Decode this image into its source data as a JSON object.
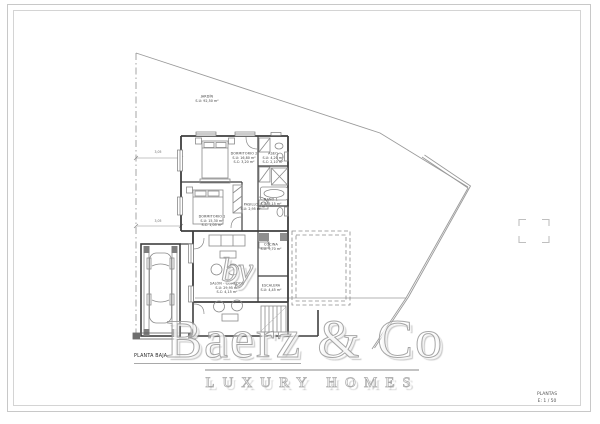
{
  "title_block": {
    "floor_label": "PLANTA BAJA",
    "sheet_name": "PLANTAS",
    "scale": "E: 1 / 50"
  },
  "watermark": {
    "prefix": "by",
    "brand": "Baerz & Co",
    "tagline": "LUXURY HOMES"
  },
  "rooms": {
    "jardin": {
      "name": "JARDÍN",
      "area": "S.U: 92,50 m²"
    },
    "dormitorio2": {
      "name": "DORMITORIO 2",
      "area": "S.U: 16,80 m²",
      "area2": "S.C: 3,20 m²"
    },
    "aseo": {
      "name": "ASEO",
      "area": "S.U: 4,20 m²",
      "area2": "S.C: 2,10 m²"
    },
    "dormitorio1": {
      "name": "DORMITORIO 1",
      "area": "S.U: 15,30 m²",
      "area2": "S.C: 1,05 m²"
    },
    "pasillo": {
      "name": "PASILLO",
      "area": "S.U: 2,95 m²"
    },
    "bano1": {
      "name": "BAÑO 1",
      "area": "S.U: 5,15 m²"
    },
    "salon": {
      "name": "SALÓN - COMEDOR",
      "area": "S.U: 29,95 m²",
      "area2": "S.C: 4,15 m²"
    },
    "cocina": {
      "name": "COCINA",
      "area": "S.U: 9,70 m²"
    },
    "escalera": {
      "name": "ESCALERA",
      "area": "S.U: 4,45 m²"
    }
  },
  "dimensions": {
    "setback_upper": "3,05",
    "setback_lower": "3,05"
  },
  "colors": {
    "wall": "#3f3f3f",
    "fixture": "#8a8a8a",
    "boundary": "#9a9a9a",
    "frame": "#c8c8c8",
    "watermark": "#969696"
  }
}
